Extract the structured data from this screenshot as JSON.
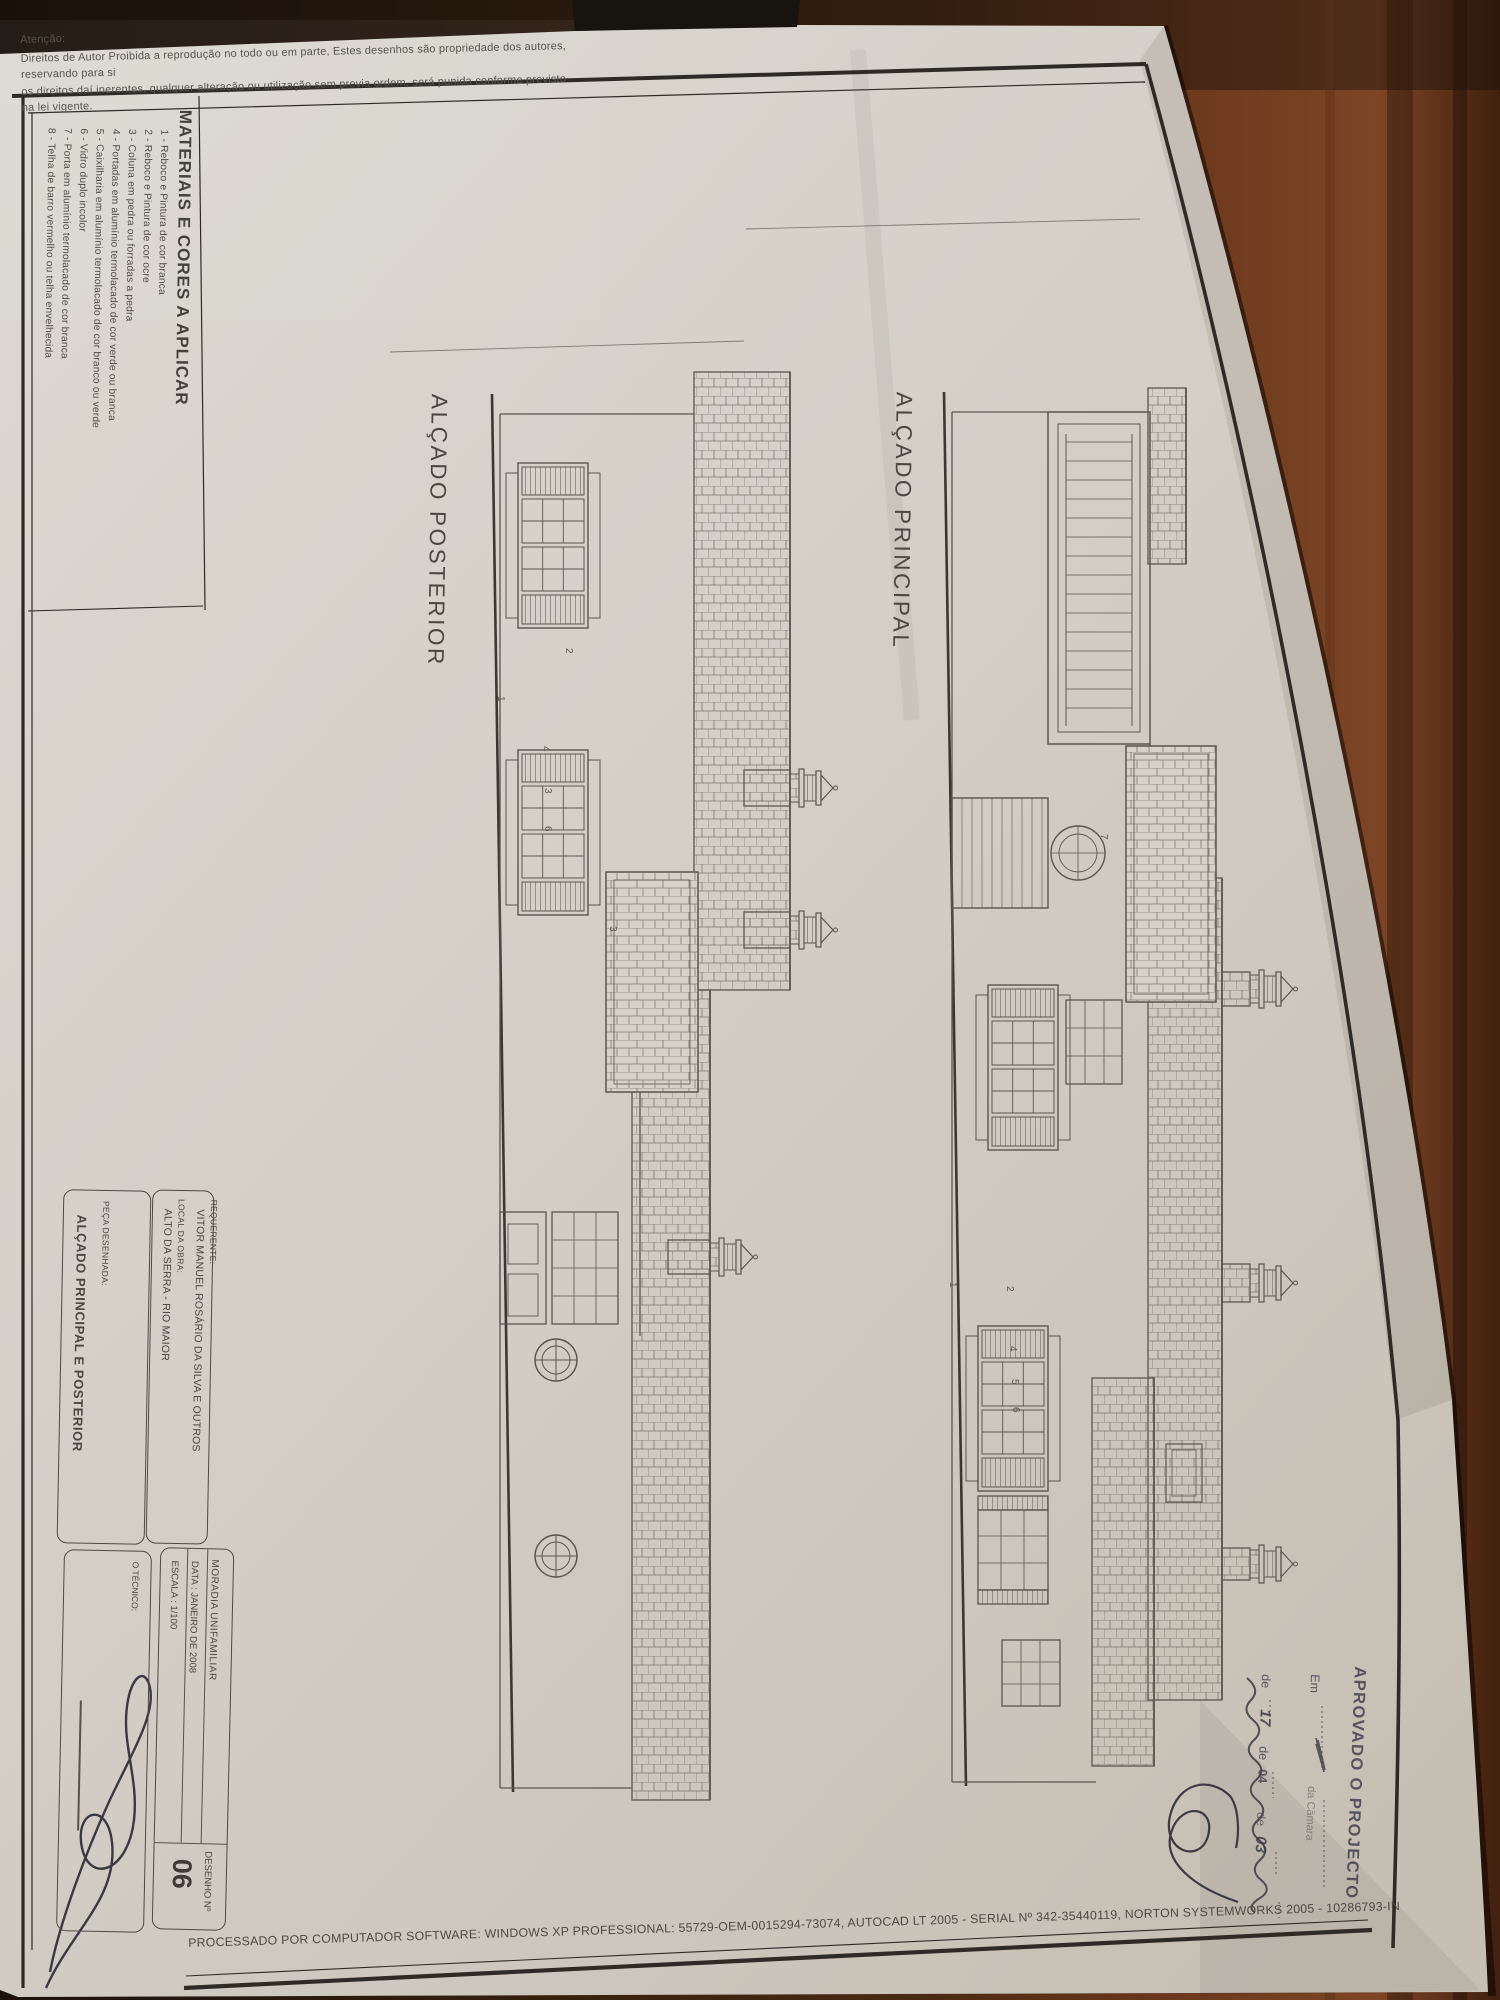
{
  "disclaimer": {
    "heading": "Atenção:",
    "line1": "Direitos de Autor Proibida a reprodução no todo ou em parte, Estes desenhos são propriedade dos autores, reservando para si",
    "line2": "os direitos daí inerentes, qualquer alteração ou utilização sem previa ordem, será punida conforme previsto na lei vigente."
  },
  "legend": {
    "title": "MATERIAIS E CORES A APLICAR",
    "items": [
      "1 - Reboco e Pintura de cor branca",
      "2 - Reboco e Pintura de cor ocre",
      "3 - Coluna em pedra ou forradas a pedra",
      "4 - Portadas em alumínio termolacado de cor verde ou branca",
      "5 - Caixilharia em alumínio termolacado de cor branco ou verde",
      "6 - Vidro duplo incolor",
      "7 - Porta em alumínio termolacado de cor branca",
      "8 - Telha de barro vermelho ou telha envelhecida"
    ]
  },
  "titles": {
    "posterior": "ALÇADO POSTERIOR",
    "principal": "ALÇADO PRINCIPAL"
  },
  "labels": {
    "posterior": [
      "2",
      "1",
      "4",
      "3",
      "6",
      "3"
    ],
    "principal": [
      "1",
      "2",
      "4",
      "5",
      "6",
      "7"
    ]
  },
  "stamp": {
    "aprovado": "APROVADO O PROJECTO",
    "em": "Em",
    "camara": "da Câmara",
    "de1": "de",
    "day": "17",
    "de2": "de",
    "month": "04",
    "de3": "de",
    "year": "03"
  },
  "title_block": {
    "requerente_label": "REQUERENTE:",
    "requerente_value": "VITOR MANUEL ROSÁRIO DA SILVA E OUTROS",
    "local_label": "LOCAL DA OBRA:",
    "local_value": "ALTO DA SERRA - RIO MAIOR",
    "peca_label": "PEÇA DESENHADA:",
    "peca_value": "ALÇADO PRINCIPAL E POSTERIOR",
    "moradia": "MORADIA UNIFAMILIAR",
    "data": "DATA : JANEIRO DE 2008",
    "escala": "ESCALA : 1/100",
    "tecnico_label": "O TÉCNICO:",
    "desenho_label": "DESENHO  Nº",
    "desenho_value": "06"
  },
  "footer": "PROCESSADO POR COMPUTADOR SOFTWARE: WINDOWS XP PROFESSIONAL:  55729-OEM-0015294-73074, AUTOCAD LT 2005 - SERIAL Nº  342-35440119, NORTON SYSTEMWORKS 2005 - 10286793-IN"
}
